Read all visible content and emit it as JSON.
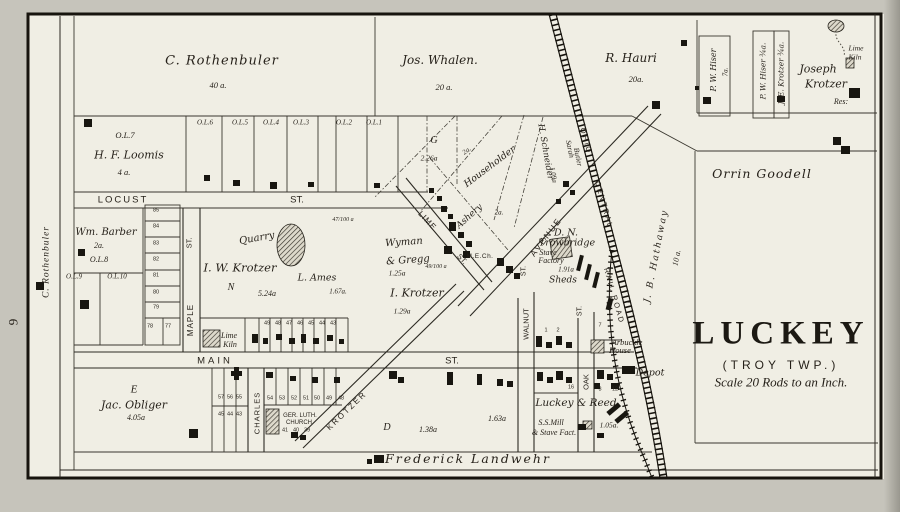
{
  "page": {
    "number": "9",
    "margin_owner": "C. Rothenbuler"
  },
  "title": {
    "name": "LUCKEY",
    "township": "(TROY TWP.)",
    "scale": "Scale 20 Rods to an Inch."
  },
  "parcels": {
    "rothenbuler": {
      "name": "C. Rothenbuler",
      "acres": "40 a."
    },
    "whalen": {
      "name": "Jos. Whalen.",
      "acres": "20 a."
    },
    "hauri": {
      "name": "R. Hauri",
      "acres": "20a."
    },
    "hiser_7a": {
      "name": "P. W. Hiser",
      "acres": "7a."
    },
    "hiser_34": {
      "name": "P. W. Hiser ¾a."
    },
    "krotzer_je": {
      "name": "J. E. Krotzer ¾a."
    },
    "krotzer_joseph": {
      "first": "Joseph",
      "last": "Krotzer",
      "res": "Res:"
    },
    "goodell": {
      "name": "Orrin Goodell"
    },
    "loomis": {
      "lot": "O.L.7",
      "name": "H. F. Loomis",
      "acres": "4 a."
    },
    "barber": {
      "name": "Wm. Barber",
      "acres": "2a.",
      "lot": "O.L.8"
    },
    "g_parcel": {
      "letter": "G",
      "acres": "2.26a"
    },
    "householder": {
      "name": "Householder",
      "acres": "2a."
    },
    "schneider": {
      "name": "H. Schneider",
      "acres": "1.09a"
    },
    "butler": {
      "first": "Sarah",
      "last": "Butler"
    },
    "hathaway": {
      "name": "J. B. Hathaway",
      "acres": "10 a."
    },
    "krotzer_iw": {
      "name": "I. W. Krotzer",
      "letter": "N",
      "acres": "5.24a"
    },
    "ames": {
      "name": "L. Ames",
      "acres": "1.67a."
    },
    "wyman": {
      "line1": "Wyman",
      "line2": "& Gregg",
      "acres": "1.25a"
    },
    "krotzer_i": {
      "name": "I. Krotzer",
      "acres": "1.29a"
    },
    "frac1": "47/100 a",
    "frac2": "49/100 a",
    "obliger": {
      "letter": "E",
      "name": "Jac. Obliger",
      "acres": "4.05a"
    },
    "d_parcel": {
      "letter": "D",
      "acres": "1.38a",
      "acres2": "1.63a"
    },
    "trowbridge": {
      "line1": "D. N.",
      "line2": "Trowbridge",
      "line3": "Stave",
      "line4": "Factory",
      "acres": "1.91a",
      "sheds": "Sheds"
    },
    "luckey_reed": {
      "name": "Luckey & Reed",
      "mill1": "S.S.Mill",
      "mill2": "& Stave Fact.",
      "acres": "1.05a."
    },
    "landwehr": {
      "name": "Frederick Landwehr"
    }
  },
  "streets": {
    "locust": "LOCUST",
    "locust_st": "ST.",
    "maple": "MAPLE",
    "maple_st": "ST.",
    "main": "MAIN",
    "main_st": "ST.",
    "charles": "CHARLES",
    "walnut": "WALNUT",
    "walnut_st": "ST.",
    "oak": "OAK",
    "oak_st": "ST.",
    "lime": "LIME",
    "lime_st": "ST.",
    "avenue": "AVENUE",
    "krotzer": "KROTZER"
  },
  "railroad": {
    "ohio": "OHIO",
    "central": "CENTRAL",
    "railroad": "RAIL ROAD"
  },
  "features": {
    "quarry": "Quarry",
    "lime_kiln_main_1": "Lime",
    "lime_kiln_main_2": "Kiln",
    "lime_kiln_ne_1": "Lime",
    "lime_kiln_ne_2": "Kiln",
    "ashery": "Ashery",
    "ashery_acres": "2a.",
    "me_church": "M.E.Ch.",
    "ger_luth_1": "GER. LUTH.",
    "ger_luth_2": "CHURCH",
    "arbuckle_1": "Arbuckle",
    "arbuckle_2": "House",
    "depot": "Depot"
  },
  "lots": {
    "outlots_top": [
      "O.L.6",
      "O.L.5",
      "O.L.4",
      "O.L.3",
      "O.L.2",
      "O.L.1"
    ],
    "outlots_west": [
      "O.L.9",
      "O.L.10"
    ],
    "column_west": [
      "85",
      "84",
      "83",
      "82",
      "81",
      "80",
      "79"
    ],
    "pair": [
      "78",
      "77"
    ],
    "main_north": [
      "49",
      "48",
      "47",
      "46",
      "45",
      "44",
      "43"
    ],
    "main_south_a": [
      "57",
      "56",
      "55"
    ],
    "main_south_b": [
      "45",
      "44",
      "43"
    ],
    "krotzer_row": [
      "54",
      "53",
      "52",
      "51",
      "50",
      "49",
      "48"
    ],
    "church_row": [
      "41",
      "40",
      "39"
    ],
    "walnut_row": [
      "1",
      "2"
    ],
    "oak_row": [
      "16",
      "3",
      "12"
    ],
    "misc_7": "7"
  },
  "colors": {
    "ink": "#241f18",
    "paper": "#f0eee4",
    "margin": "#c6c4bb"
  }
}
